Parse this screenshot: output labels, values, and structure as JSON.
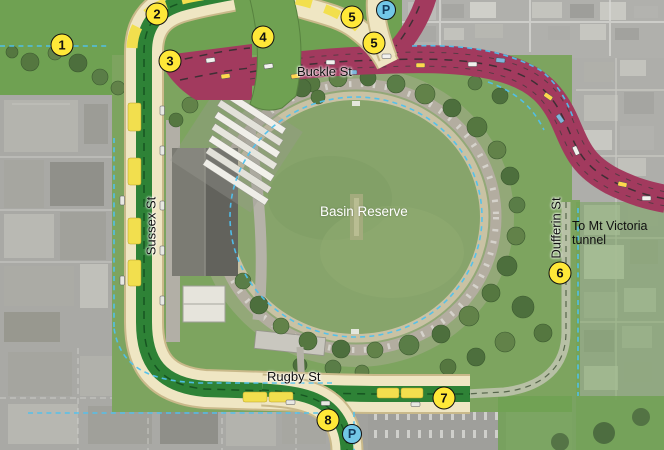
{
  "map": {
    "description": "Aerial plan of the Basin Reserve with proposed traffic routes",
    "labels": [
      {
        "id": "buckle-st-label",
        "text": "Buckle St",
        "x": 297,
        "y": 65,
        "style": "street"
      },
      {
        "id": "sussex-st-label",
        "text": "Sussex St",
        "x": 152,
        "y": 226,
        "style": "street-vertical"
      },
      {
        "id": "dufferin-st-label",
        "text": "Dufferin St",
        "x": 557,
        "y": 228,
        "style": "street-vertical"
      },
      {
        "id": "rugby-st-label",
        "text": "Rugby St",
        "x": 267,
        "y": 370,
        "style": "street"
      },
      {
        "id": "basin-reserve-label",
        "text": "Basin Reserve",
        "x": 320,
        "y": 204,
        "style": "area"
      },
      {
        "id": "mt-victoria-label",
        "text": "To Mt Victoria tunnel",
        "x": 572,
        "y": 219,
        "style": "destination"
      }
    ],
    "numbered_markers": [
      {
        "n": "1",
        "x": 62,
        "y": 45
      },
      {
        "n": "2",
        "x": 157,
        "y": 14
      },
      {
        "n": "3",
        "x": 170,
        "y": 61
      },
      {
        "n": "4",
        "x": 263,
        "y": 37
      },
      {
        "n": "5",
        "x": 352,
        "y": 17
      },
      {
        "n": "5",
        "x": 374,
        "y": 43
      },
      {
        "n": "6",
        "x": 560,
        "y": 273
      },
      {
        "n": "7",
        "x": 444,
        "y": 398
      },
      {
        "n": "8",
        "x": 328,
        "y": 420
      }
    ],
    "parking_markers": [
      {
        "label": "P",
        "x": 386,
        "y": 10
      },
      {
        "label": "P",
        "x": 352,
        "y": 434
      }
    ]
  },
  "colors": {
    "bus_route_green": "#2e8236",
    "road_cream": "#efe6c3",
    "road_edge": "#c9b98a",
    "bus_stop_yellow": "#f2df4e",
    "traffic_route_maroon": "#a23a5e",
    "cycle_blue": "#4fc1ee",
    "marker_yellow": "#ffe838",
    "parking_blue": "#72c7e7",
    "park_green": "#6fa152",
    "field_green": "#87a46b"
  }
}
